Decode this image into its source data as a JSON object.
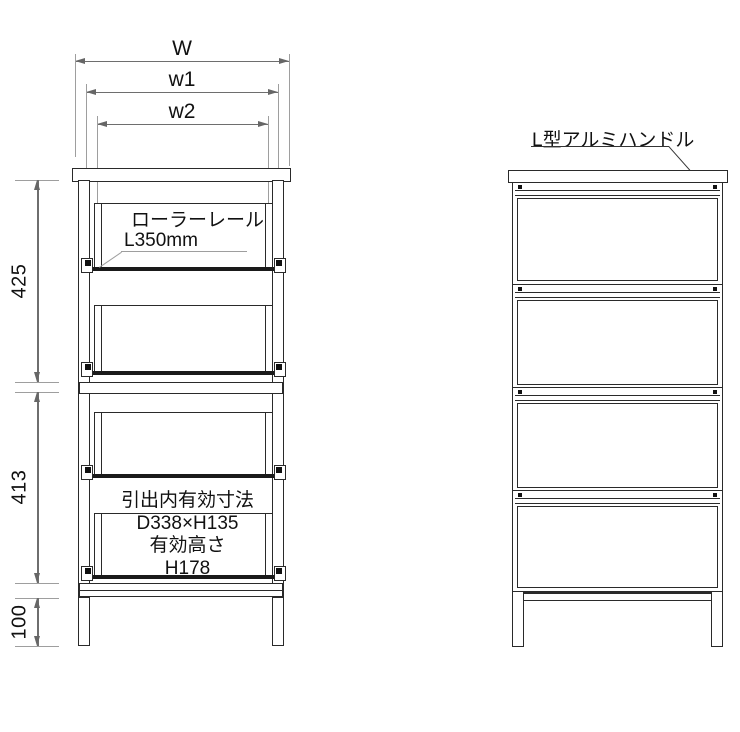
{
  "drawing": {
    "type": "furniture-technical-drawing",
    "colors": {
      "line": "#2a2a2a",
      "dim_line": "#6e6e6e",
      "ext_line": "#9e9e9e",
      "text": "#111111",
      "bg": "#ffffff"
    },
    "front_view": {
      "width_dims": [
        {
          "label": "W"
        },
        {
          "label": "w1"
        },
        {
          "label": "w2"
        }
      ],
      "height_dims": [
        {
          "label": "425"
        },
        {
          "label": "413"
        },
        {
          "label": "100"
        }
      ],
      "roller_note": {
        "line1": "ローラーレール",
        "line2": "L350mm"
      },
      "drawer_note": {
        "line1": "引出内有効寸法",
        "line2": "D338×H135",
        "line3": "有効高さ",
        "line4": "H178"
      },
      "drawer_count": 4
    },
    "side_view": {
      "handle_note": "L型アルミハンドル",
      "drawer_count": 4
    }
  }
}
